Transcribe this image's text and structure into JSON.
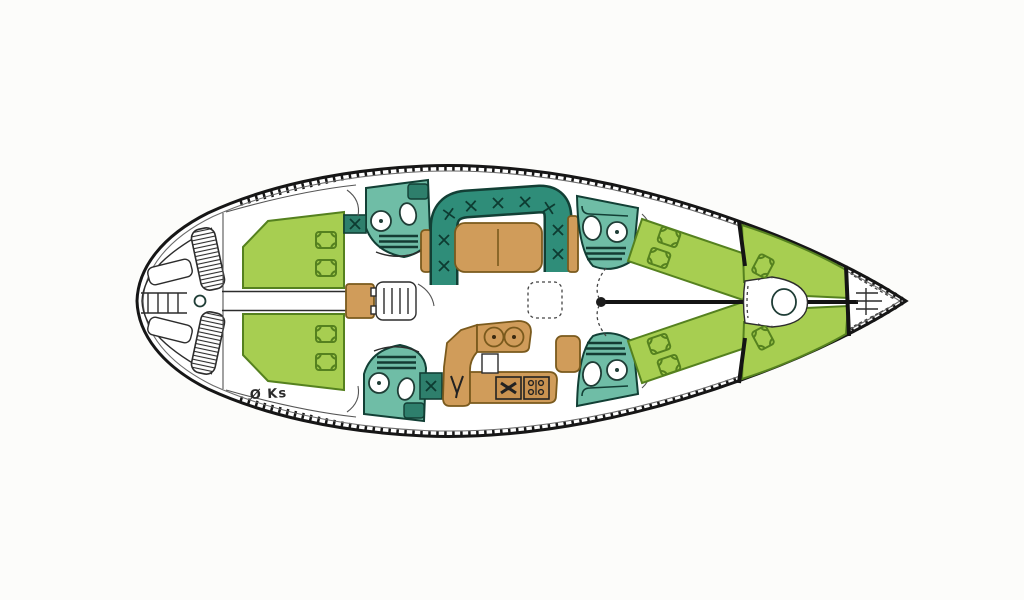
{
  "watermark": {
    "text": "Ø Ks"
  },
  "colors": {
    "hull_line": "#161616",
    "berth_green": "#a7ce51",
    "berth_outline": "#55811f",
    "head_teal": "#6fbda6",
    "settee_teal": "#2f8d79",
    "seat_teal": "#2e7f6c",
    "teal_outline": "#123f35",
    "wood_tan": "#d09c5a",
    "wood_outline": "#7a5a1d",
    "background": "#fcfcfa"
  },
  "icon_names": [
    "swim-ladder-icon",
    "helm-pedestal-icon",
    "companionway-steps-icon",
    "windlass-icon",
    "toilet-icon",
    "sink-icon",
    "stove-icon",
    "sink-drain-icon",
    "floor-hatch-icon",
    "mast-icon",
    "hanging-locker-icon"
  ]
}
